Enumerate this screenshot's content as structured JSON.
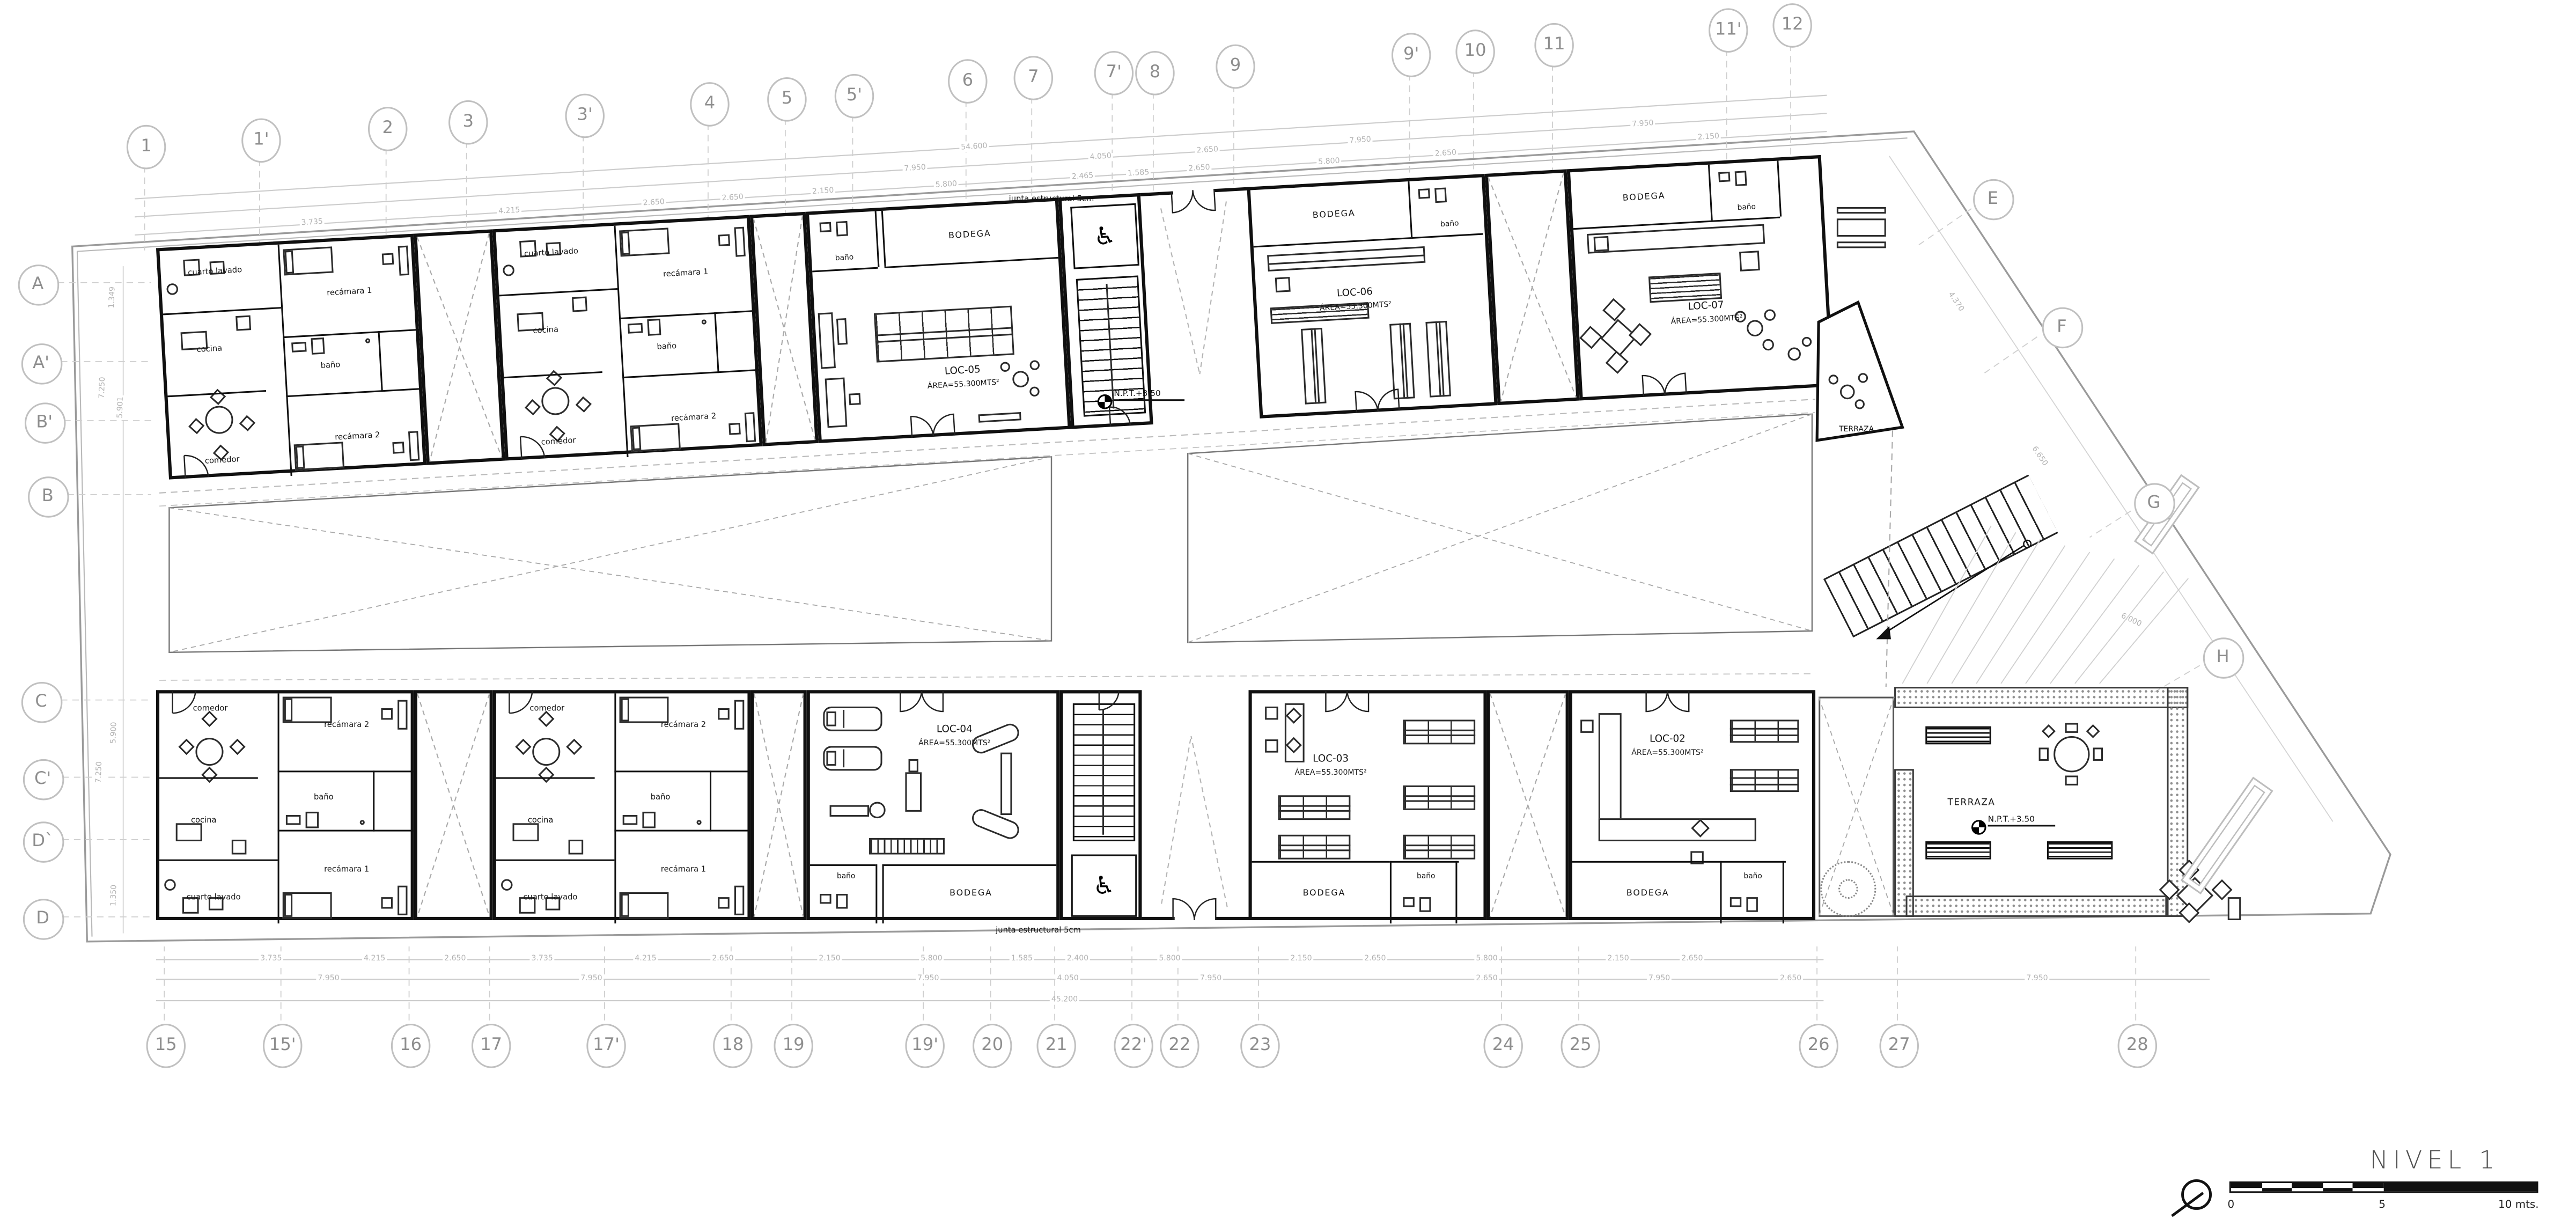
{
  "plan": {
    "title": "NIVEL  1",
    "scale": {
      "zero": "0",
      "five": "5",
      "ten": "10 mts."
    },
    "level_note": "N.P.T.+3.50",
    "junta_note": "junta estructural 5cm"
  },
  "grid": {
    "top": [
      "1",
      "1'",
      "2",
      "3",
      "3'",
      "4",
      "5",
      "5'",
      "6",
      "7",
      "7'",
      "8",
      "9",
      "9'",
      "10",
      "11",
      "11'",
      "12"
    ],
    "bottom": [
      "15",
      "15'",
      "16",
      "17",
      "17'",
      "18",
      "19",
      "19'",
      "20",
      "21",
      "22'",
      "22",
      "23",
      "24",
      "25",
      "26",
      "27",
      "28"
    ],
    "left": [
      "A",
      "A'",
      "B'",
      "B",
      "C",
      "C'",
      "D`",
      "D"
    ],
    "right": [
      "E",
      "F",
      "G",
      "H"
    ]
  },
  "rooms": {
    "laundry": "cuarto lavado",
    "kitchen": "cocina",
    "dining": "comedor",
    "bedroom1": "recámara 1",
    "bedroom2": "recámara 2",
    "bath": "baño",
    "storage": "BODEGA",
    "terrace": "TERRAZA"
  },
  "locales": {
    "loc02": {
      "name": "LOC-02",
      "area": "ÁREA=55.300MTS²"
    },
    "loc03": {
      "name": "LOC-03",
      "area": "ÁREA=55.300MTS²"
    },
    "loc04": {
      "name": "LOC-04",
      "area": "ÁREA=55.300MTS²"
    },
    "loc05": {
      "name": "LOC-05",
      "area": "ÁREA=55.300MTS²"
    },
    "loc06": {
      "name": "LOC-06",
      "area": "ÁREA=55.300MTS²"
    },
    "loc07": {
      "name": "LOC-07",
      "area": "ÁREA=55.300MTS²"
    }
  },
  "dims": {
    "top_a": [
      "54.600"
    ],
    "top_b": [
      "7.950",
      "4.050",
      "2.650",
      "7.950",
      "7.950"
    ],
    "top_c": [
      "3.735",
      "4.215",
      "2.650",
      "2.650",
      "2.150",
      "5.800",
      "2.465",
      "1.585",
      "2.650",
      "5.800",
      "2.650",
      "2.150"
    ],
    "bottom_1": [
      "3.735",
      "4.215",
      "2.650",
      "3.735",
      "4.215",
      "2.650",
      "2.150",
      "5.800",
      "1.585",
      "2.400",
      "5.800",
      "2.150",
      "2.650",
      "5.800",
      "2.150",
      "2.650"
    ],
    "bottom_2": [
      "7.950",
      "7.950",
      "7.950",
      "4.050",
      "7.950",
      "2.650",
      "7.950",
      "2.650",
      "7.950"
    ],
    "bottom_3": [
      "45.200"
    ],
    "left": [
      "1.349",
      "7.250",
      "5.901",
      "5.900",
      "7.250",
      "1.350"
    ],
    "right": [
      "4.370",
      "6.650",
      "6.000"
    ]
  }
}
